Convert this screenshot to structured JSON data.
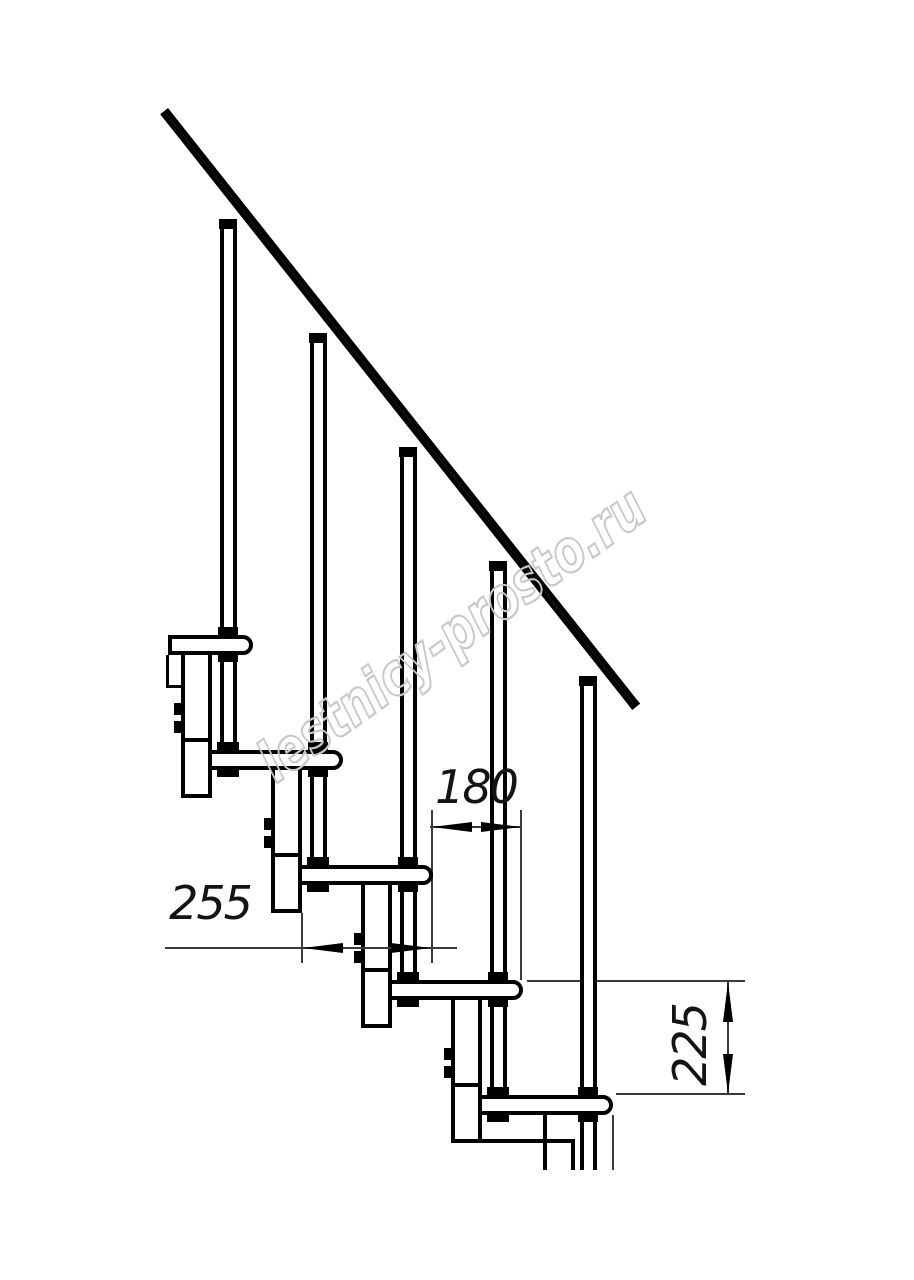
{
  "canvas": {
    "width": 914,
    "height": 1280,
    "background": "#ffffff"
  },
  "colors": {
    "outline": "#000000",
    "thin_line": "#3a3a3a",
    "dimension_text": "#141414",
    "watermark": "#c8c8c8"
  },
  "watermark": {
    "text": "lestnicy-prosto.ru"
  },
  "dimensions": [
    {
      "id": "dim-255",
      "value": "255",
      "orientation": "horizontal"
    },
    {
      "id": "dim-180",
      "value": "180",
      "orientation": "horizontal"
    },
    {
      "id": "dim-225",
      "value": "225",
      "orientation": "vertical"
    }
  ],
  "drawing": {
    "treads_visible": 5,
    "balusters_visible": 5,
    "support_columns_visible": 4,
    "handrails_visible": 1
  }
}
